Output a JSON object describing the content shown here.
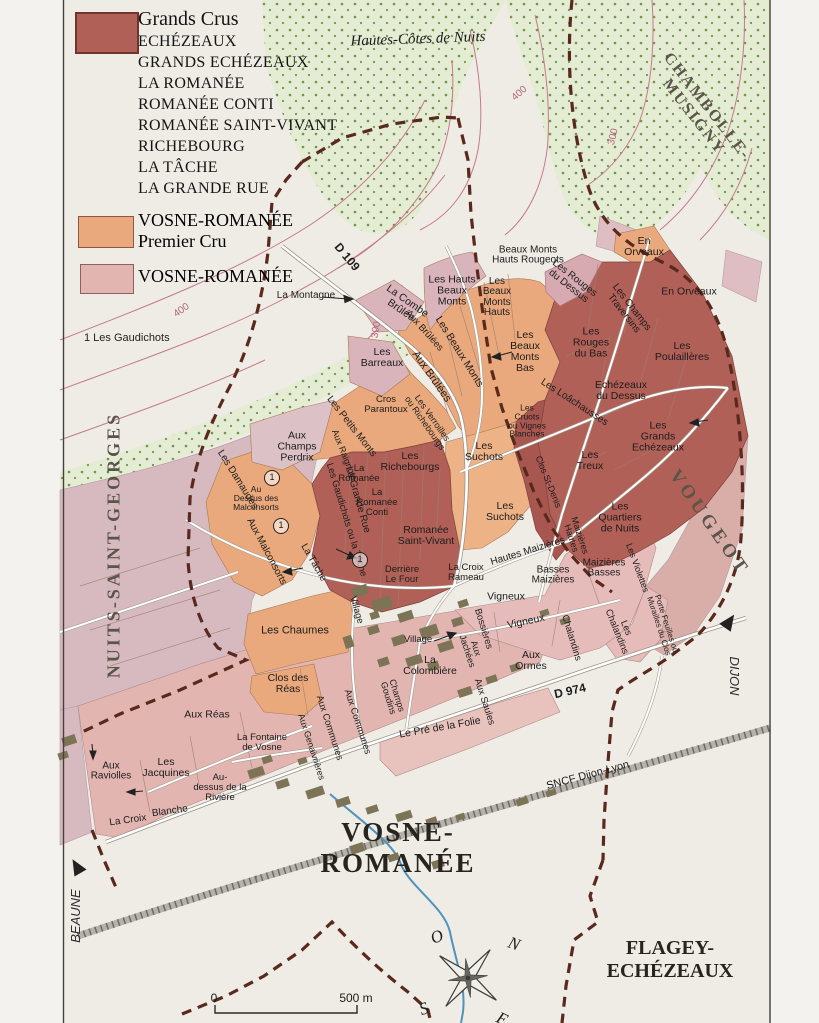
{
  "colors": {
    "paper": "#efece6",
    "paper_out": "#f4f2ee",
    "grand_cru": "#b16057",
    "grand_cru_dark": "#a85750",
    "premier_cru": "#e9a97c",
    "premier_cru_light": "#edb286",
    "village_pink": "#e2b5b0",
    "village_light": "#e8c2bd",
    "maizieres_pink": "#e6bcba",
    "vougeot": "#d9ada8",
    "nsg_pale": "#d6bac0",
    "pale_mauve": "#d9b4ba",
    "chambolle_pink": "#dfbec3",
    "woodland": "#e4ecd3",
    "woodland_dot": "#71944e",
    "boundary": "#5a291d",
    "contour": "#c4798a",
    "stream": "#4f93bd",
    "building": "#7d7457",
    "road_casing": "#9a9184",
    "frame": "#44403a"
  },
  "legend": {
    "grands_crus_title": "Grands Crus",
    "grand_cru_names": [
      "ECHÉZEAUX",
      "GRANDS ECHÉZEAUX",
      "LA ROMANÉE",
      "ROMANÉE CONTI",
      "ROMANÉE SAINT-VIVANT",
      "RICHEBOURG",
      "LA TÂCHE",
      "LA GRANDE RUE"
    ],
    "premier_cru_line1": "VOSNE-ROMANÉE",
    "premier_cru_line2": "Premier Cru",
    "village_label": "VOSNE-ROMANÉE",
    "footnote": "1  Les Gaudichots"
  },
  "map": {
    "scale": {
      "zero": "0",
      "distance": "500 m"
    },
    "labels": [
      {
        "n": "hautes-cotes-label",
        "t": "Hautes-Côtes de Nuits",
        "x": 418,
        "y": 40,
        "r": -2,
        "s": 15,
        "c": "serif it"
      },
      {
        "n": "chambolle-label",
        "t": "CHAMBOLLE-\nMUSIGNY",
        "x": 700,
        "y": 112,
        "r": 52,
        "s": 16,
        "c": "serif commune ls2"
      },
      {
        "n": "nuits-label",
        "t": "NUITS-SAINT-GEORGES",
        "x": 114,
        "y": 545,
        "r": -90,
        "s": 18,
        "c": "serif commune ls3"
      },
      {
        "n": "vougeot-label",
        "t": "VOUGEOT",
        "x": 709,
        "y": 523,
        "r": 55,
        "s": 19,
        "c": "serif commune ls4"
      },
      {
        "n": "vosne-title",
        "t": "VOSNE-\nROMANÉE",
        "x": 398,
        "y": 848,
        "r": 0,
        "s": 27,
        "c": "serif town ls2"
      },
      {
        "n": "flagey-label",
        "t": "FLAGEY-\nECHÉZEAUX",
        "x": 670,
        "y": 960,
        "r": 0,
        "s": 20,
        "c": "serif town"
      },
      {
        "n": "dijon-label",
        "t": "DIJON",
        "x": 734,
        "y": 676,
        "r": 90,
        "s": 13,
        "c": "it dir"
      },
      {
        "n": "beaune-label",
        "t": "BEAUNE",
        "x": 76,
        "y": 916,
        "r": -90,
        "s": 13,
        "c": "it dir"
      },
      {
        "n": "sncf-label",
        "t": "SNCF Dijon-Lyon",
        "x": 588,
        "y": 776,
        "r": -15,
        "s": 11,
        "c": ""
      },
      {
        "n": "d109-label",
        "t": "D 109",
        "x": 347,
        "y": 257,
        "r": 50,
        "s": 12,
        "c": "bold"
      },
      {
        "n": "d974-label",
        "t": "D 974",
        "x": 570,
        "y": 691,
        "r": -13,
        "s": 12,
        "c": "bold"
      },
      {
        "n": "contour-400-a",
        "t": "400",
        "x": 182,
        "y": 311,
        "r": -35,
        "s": 10,
        "c": "contour"
      },
      {
        "n": "contour-400-b",
        "t": "400",
        "x": 520,
        "y": 94,
        "r": -42,
        "s": 10,
        "c": "contour"
      },
      {
        "n": "contour-300-a",
        "t": "300",
        "x": 614,
        "y": 137,
        "r": -76,
        "s": 10,
        "c": "contour"
      },
      {
        "n": "contour-300-b",
        "t": "300",
        "x": 377,
        "y": 330,
        "r": -80,
        "s": 10,
        "c": "contour"
      },
      {
        "t": "Les Hauts\nBeaux\nMonts",
        "x": 452,
        "y": 291
      },
      {
        "t": "Beaux Monts\nHauts Rougeots",
        "x": 528,
        "y": 256,
        "s": 10
      },
      {
        "t": "Les\nBeaux\nMonts\nHauts",
        "x": 497,
        "y": 298,
        "s": 10
      },
      {
        "t": "Les Rouges\ndu Dessus",
        "x": 571,
        "y": 283,
        "r": 38,
        "s": 10
      },
      {
        "t": "En\nOrveaux",
        "x": 644,
        "y": 247
      },
      {
        "t": "En Orveaux",
        "x": 689,
        "y": 292
      },
      {
        "t": "Les Champs\nTraversins",
        "x": 627,
        "y": 311,
        "r": 52,
        "s": 10
      },
      {
        "t": "Les\nRouges\ndu Bas",
        "x": 591,
        "y": 343
      },
      {
        "t": "Les\nPoulaillères",
        "x": 682,
        "y": 352
      },
      {
        "t": "Echézeaux\ndu Dessus",
        "x": 621,
        "y": 391
      },
      {
        "t": "Les Loâchausses",
        "x": 574,
        "y": 403,
        "r": 33,
        "s": 10
      },
      {
        "t": "Les\nCruots\nou Vignes\nBlanches",
        "x": 527,
        "y": 421,
        "s": 8.5
      },
      {
        "t": "Les\nGrands\nEchézeaux",
        "x": 658,
        "y": 437
      },
      {
        "t": "Les\nTreux",
        "x": 590,
        "y": 461
      },
      {
        "t": "Les\nQuartiers\nde Nuits",
        "x": 620,
        "y": 518
      },
      {
        "t": "Clos St-Denis",
        "x": 548,
        "y": 482,
        "r": 68,
        "s": 9
      },
      {
        "t": "Les\nSuchots",
        "x": 484,
        "y": 452
      },
      {
        "t": "Les\nSuchots",
        "x": 505,
        "y": 512
      },
      {
        "t": "La Montagne",
        "x": 306,
        "y": 296,
        "s": 10
      },
      {
        "t": "La Combe\nBrûlée",
        "x": 404,
        "y": 306,
        "r": 35,
        "s": 10.5
      },
      {
        "t": "Les\nBarreaux",
        "x": 382,
        "y": 358
      },
      {
        "t": "Aux Brûlées",
        "x": 424,
        "y": 331,
        "r": 48,
        "s": 9.5
      },
      {
        "t": "Aux Brûlées",
        "x": 431,
        "y": 377,
        "r": 55,
        "s": 11
      },
      {
        "t": "Les Beaux Monts",
        "x": 459,
        "y": 352,
        "r": 58,
        "s": 10.5
      },
      {
        "t": "Les\nBeaux\nMonts\nBas",
        "x": 525,
        "y": 352
      },
      {
        "t": "Cros\nParantoux",
        "x": 386,
        "y": 405,
        "s": 9.5
      },
      {
        "t": "Les Petits Monts",
        "x": 351,
        "y": 427,
        "r": 52,
        "s": 10
      },
      {
        "t": "Aux Raignots",
        "x": 344,
        "y": 455,
        "r": 68,
        "s": 9
      },
      {
        "t": "Aux\nChamps\nPerdrix",
        "x": 297,
        "y": 447
      },
      {
        "t": "Les Damaudes",
        "x": 237,
        "y": 480,
        "r": 58,
        "s": 10
      },
      {
        "t": "Au\nDessus des\nMalconsorts",
        "x": 256,
        "y": 498,
        "s": 8.5
      },
      {
        "t": "Aux Malconsorts",
        "x": 266,
        "y": 552,
        "r": 62,
        "s": 10
      },
      {
        "t": "Les Gaudichots ou la Tâche",
        "x": 346,
        "y": 520,
        "r": 73,
        "s": 9.5
      },
      {
        "t": "La Tâche",
        "x": 313,
        "y": 563,
        "r": 60,
        "s": 10
      },
      {
        "t": "La Grande Rue",
        "x": 357,
        "y": 500,
        "r": 74,
        "s": 10
      },
      {
        "t": "La\nRomanée",
        "x": 359,
        "y": 474,
        "s": 9.5
      },
      {
        "t": "La\nRomanée\nConti",
        "x": 377,
        "y": 503,
        "s": 9.5
      },
      {
        "t": "Les\nRichebourgs",
        "x": 410,
        "y": 462
      },
      {
        "t": "Les Verroilles\nou Richebourgs",
        "x": 428,
        "y": 421,
        "r": 55,
        "s": 9
      },
      {
        "t": "Romanée\nSaint-Vivant",
        "x": 426,
        "y": 536
      },
      {
        "t": "Derrière\nLe Four",
        "x": 402,
        "y": 575,
        "s": 9.5
      },
      {
        "t": "La Croix\nRameau",
        "x": 466,
        "y": 573,
        "s": 9.5
      },
      {
        "t": "Hautes Maizières",
        "x": 528,
        "y": 552,
        "r": -17,
        "s": 10
      },
      {
        "t": "Maizières\nHautes",
        "x": 575,
        "y": 537,
        "r": 72,
        "s": 9
      },
      {
        "t": "Basses\nMaizières",
        "x": 553,
        "y": 576,
        "s": 10
      },
      {
        "t": "Maizières\nBasses",
        "x": 604,
        "y": 569,
        "s": 10
      },
      {
        "t": "Les Violettes",
        "x": 637,
        "y": 568,
        "r": 70,
        "s": 9
      },
      {
        "t": "Porte Feuilles ou\nMurailles du Clos",
        "x": 662,
        "y": 625,
        "r": 72,
        "s": 8
      },
      {
        "t": "Les\nChalandins",
        "x": 621,
        "y": 630,
        "r": 68,
        "s": 9.5
      },
      {
        "t": "Chalandins",
        "x": 571,
        "y": 638,
        "r": 73,
        "s": 9.5
      },
      {
        "t": "Vigneux",
        "x": 506,
        "y": 597
      },
      {
        "t": "Vigneux",
        "x": 526,
        "y": 622,
        "r": -12
      },
      {
        "t": "Bossières",
        "x": 483,
        "y": 629,
        "r": 73,
        "s": 9.5
      },
      {
        "t": "Aux\nJachées",
        "x": 471,
        "y": 650,
        "r": 72,
        "s": 9
      },
      {
        "t": "Aux\nOrmes",
        "x": 531,
        "y": 661
      },
      {
        "t": "Aux Saules",
        "x": 484,
        "y": 702,
        "r": 72,
        "s": 9.5
      },
      {
        "t": "Le Pré de la Folie",
        "x": 440,
        "y": 728,
        "r": -10,
        "s": 10.5
      },
      {
        "t": "Les Chaumes",
        "x": 295,
        "y": 631,
        "s": 11
      },
      {
        "t": "Clos des\nRéas",
        "x": 288,
        "y": 684,
        "s": 10.5
      },
      {
        "t": "Village",
        "x": 356,
        "y": 610,
        "r": 74,
        "s": 9.5
      },
      {
        "t": "Village",
        "x": 418,
        "y": 640,
        "s": 9.5
      },
      {
        "t": "La\nColombière",
        "x": 430,
        "y": 666,
        "s": 10.5
      },
      {
        "t": "Champs\nGoudins",
        "x": 392,
        "y": 697,
        "r": 73,
        "s": 9
      },
      {
        "t": "Aux Communes",
        "x": 357,
        "y": 722,
        "r": 72,
        "s": 9.5
      },
      {
        "t": "Aux Communes",
        "x": 329,
        "y": 728,
        "r": 72,
        "s": 9.5
      },
      {
        "t": "Aux Genaivrières",
        "x": 311,
        "y": 747,
        "r": 72,
        "s": 9
      },
      {
        "t": "La Fontaine\nde Vosne",
        "x": 262,
        "y": 743,
        "s": 9.5
      },
      {
        "t": "Aux Réas",
        "x": 207,
        "y": 715,
        "s": 10.5
      },
      {
        "t": "Les\nJacquines",
        "x": 166,
        "y": 768,
        "s": 10.5
      },
      {
        "t": "Aux\nRaviolles",
        "x": 111,
        "y": 772,
        "s": 10
      },
      {
        "t": "Au-\ndessus de la\nRivière",
        "x": 220,
        "y": 788,
        "s": 9.5
      },
      {
        "t": "La Croix",
        "x": 128,
        "y": 821,
        "r": -8,
        "s": 10
      },
      {
        "t": "Blanche",
        "x": 170,
        "y": 812,
        "r": -8,
        "s": 10
      },
      {
        "n": "compass-letter-o",
        "t": "O",
        "x": 437,
        "y": 937,
        "r": -25,
        "s": 17,
        "c": "serif it"
      },
      {
        "n": "compass-letter-n",
        "t": "N",
        "x": 514,
        "y": 944,
        "r": 20,
        "s": 17,
        "c": "serif it"
      },
      {
        "n": "compass-letter-s",
        "t": "S",
        "x": 424,
        "y": 1009,
        "r": -20,
        "s": 17,
        "c": "serif it"
      },
      {
        "n": "compass-letter-e",
        "t": "E",
        "x": 502,
        "y": 1019,
        "r": 25,
        "s": 17,
        "c": "serif it"
      },
      {
        "n": "scale-zero",
        "t": "0",
        "x": 214,
        "y": 998,
        "r": 0,
        "s": 12,
        "c": ""
      },
      {
        "n": "scale-distance",
        "t": "500 m",
        "x": 356,
        "y": 998,
        "r": 0,
        "s": 12,
        "c": ""
      },
      {
        "n": "marker-1-a",
        "t": "1",
        "x": 272,
        "y": 478,
        "r": 0,
        "s": 9,
        "c": "circ"
      },
      {
        "n": "marker-1-b",
        "t": "1",
        "x": 281,
        "y": 526,
        "r": 0,
        "s": 9,
        "c": "circ"
      },
      {
        "n": "marker-1-c",
        "t": "1",
        "x": 360,
        "y": 560,
        "r": 0,
        "s": 9,
        "c": "circ"
      }
    ]
  }
}
